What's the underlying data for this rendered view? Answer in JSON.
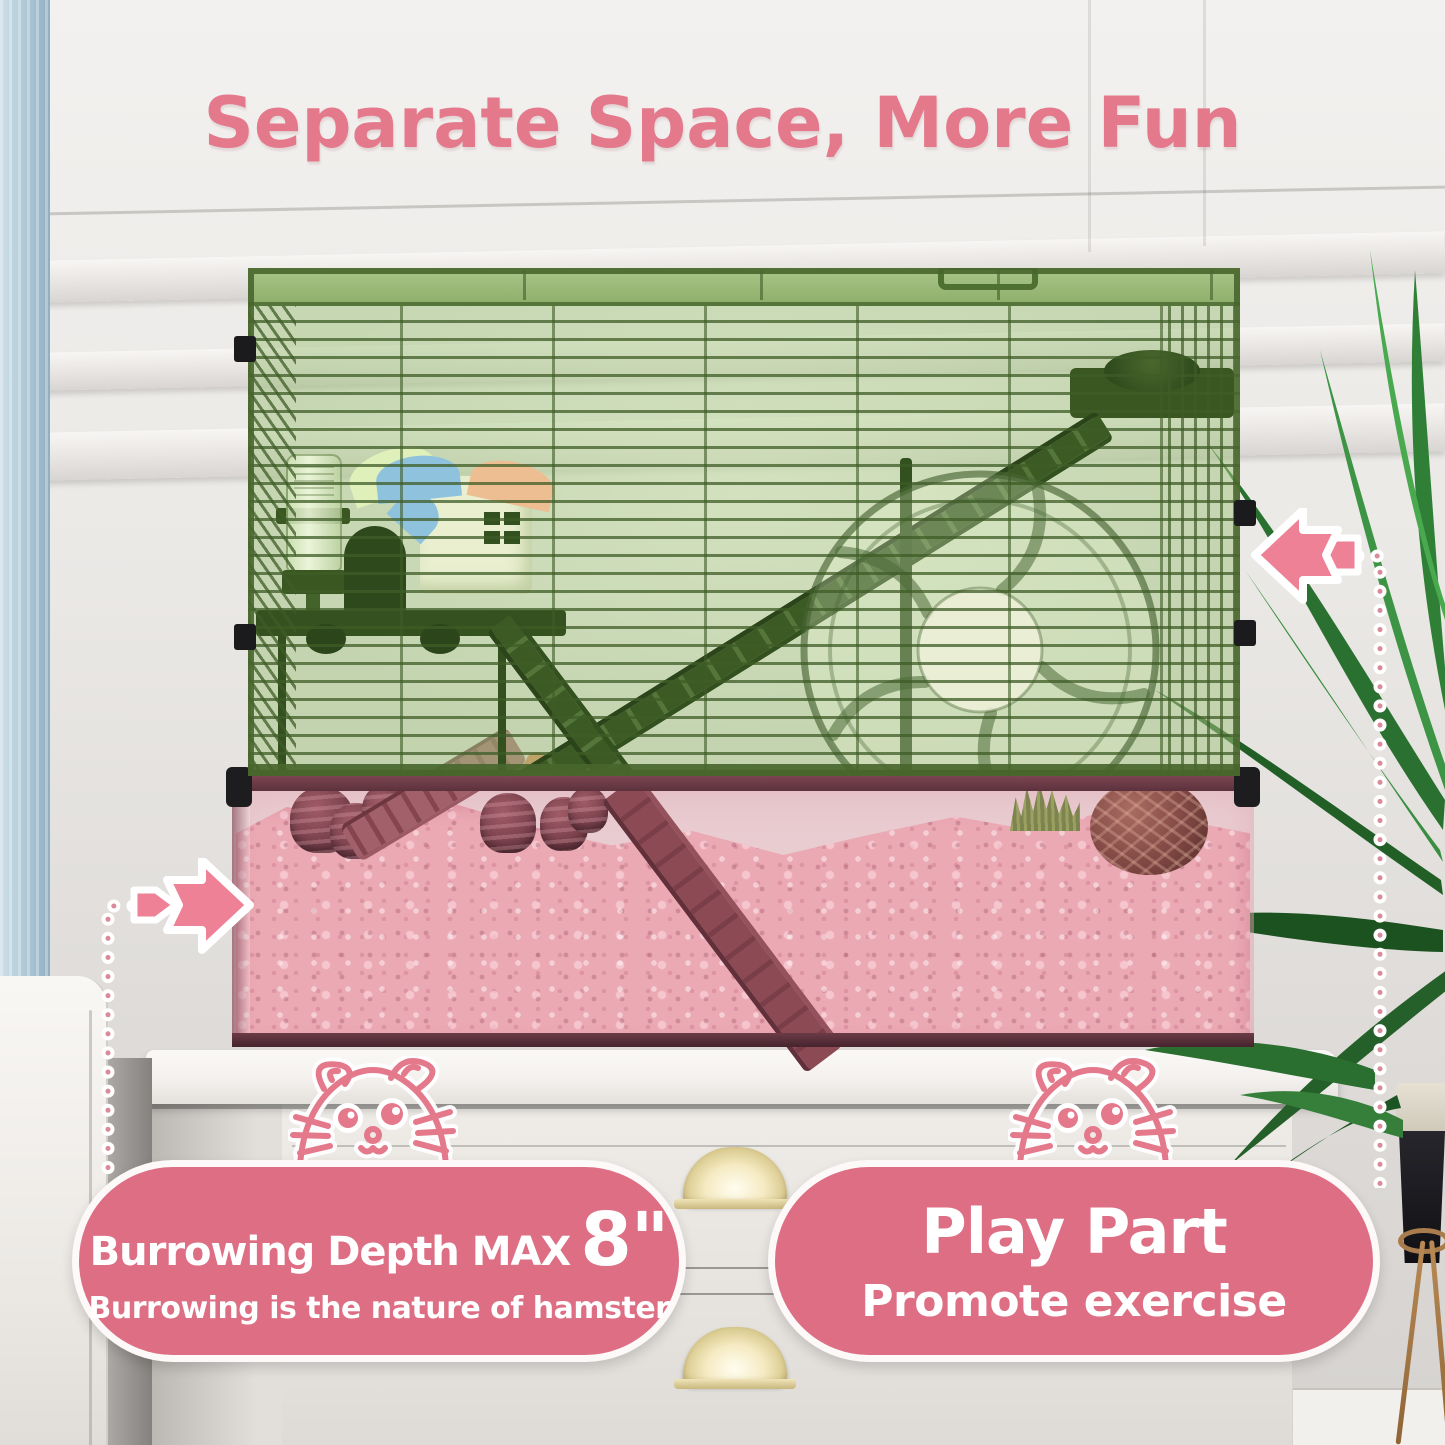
{
  "title": {
    "text": "Separate Space, More Fun"
  },
  "badges": {
    "left": {
      "heading": "Burrowing Depth MAX",
      "highlight": "8\"",
      "subtext": "Burrowing is the nature of hamster"
    },
    "right": {
      "heading": "Play Part",
      "subtext": "Promote exercise"
    }
  },
  "icons": {
    "left_pointer": "arrow-right-icon",
    "right_pointer": "arrow-left-icon",
    "left_mascot": "hamster-face-icon",
    "right_mascot": "hamster-face-icon"
  },
  "colors": {
    "title-pink": "#e4798c",
    "badge-pink": "#dd6e83",
    "badge-border": "#fdf9f8",
    "arrow-pink": "#ee8196",
    "dot-pink": "#d98a9b",
    "cage-green": "#a3c480",
    "wire-green": "#3e5c26",
    "bedding-pink": "#eba9b4",
    "bin-rim": "#6b3b46",
    "wall-gray": "#eae8e5",
    "curtain-blue": "#aec7d5",
    "dresser-white": "#edeae6",
    "handle-gold": "#e6d9a8",
    "plant-green": "#2f7d33",
    "wood-brown": "#8c4a55"
  }
}
